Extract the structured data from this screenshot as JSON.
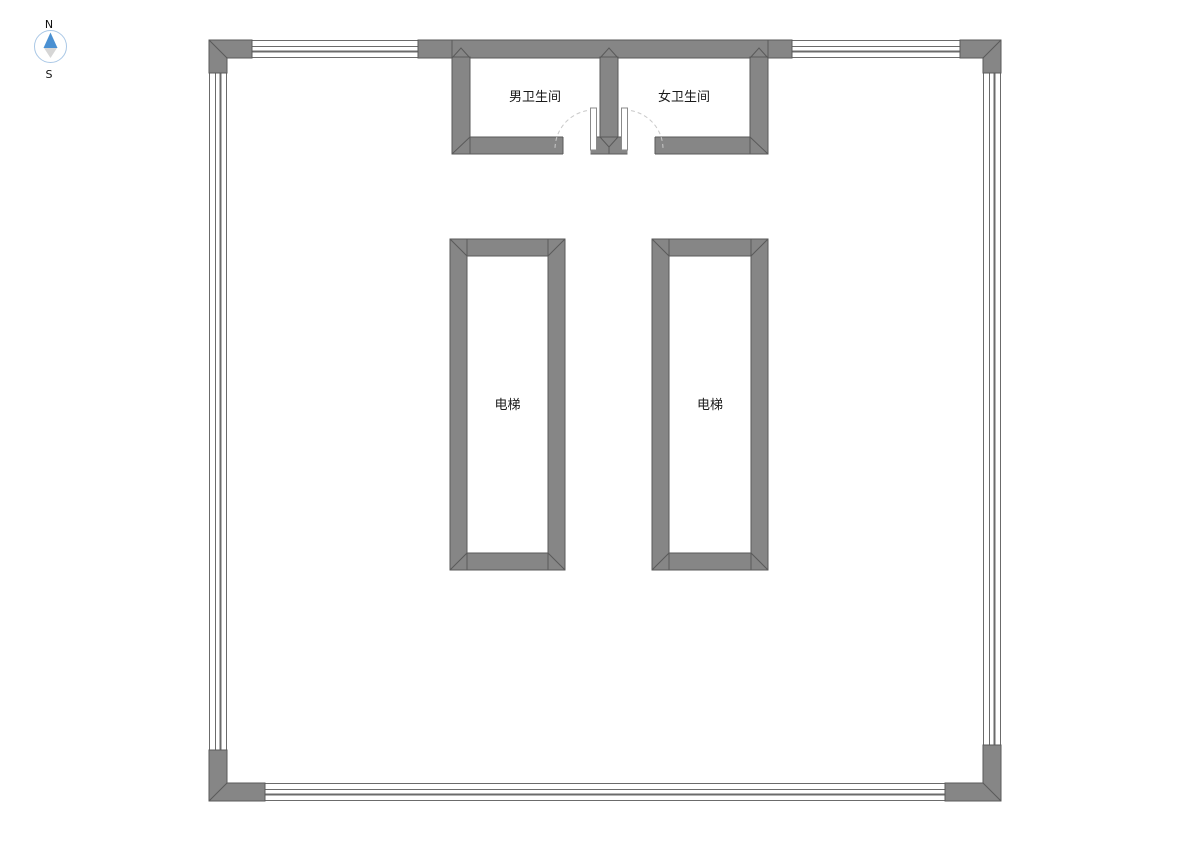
{
  "compass": {
    "north_label": "N",
    "south_label": "S"
  },
  "rooms": {
    "mens_restroom": {
      "label": "男卫生间"
    },
    "womens_restroom": {
      "label": "女卫生间"
    },
    "elevator_left": {
      "label": "电梯"
    },
    "elevator_right": {
      "label": "电梯"
    }
  },
  "colors": {
    "background": "#ffffff",
    "wall_fill": "#868686",
    "wall_edge": "#5a5a5a",
    "window_line": "#6b6b6b",
    "door_arc": "#c9c9c9",
    "door_leaf_edge": "#8a8a8a",
    "label_text": "#1a1a1a",
    "compass_north": "#4a90d2",
    "compass_south": "#d6d6d6",
    "compass_ring": "#aac8e6"
  }
}
